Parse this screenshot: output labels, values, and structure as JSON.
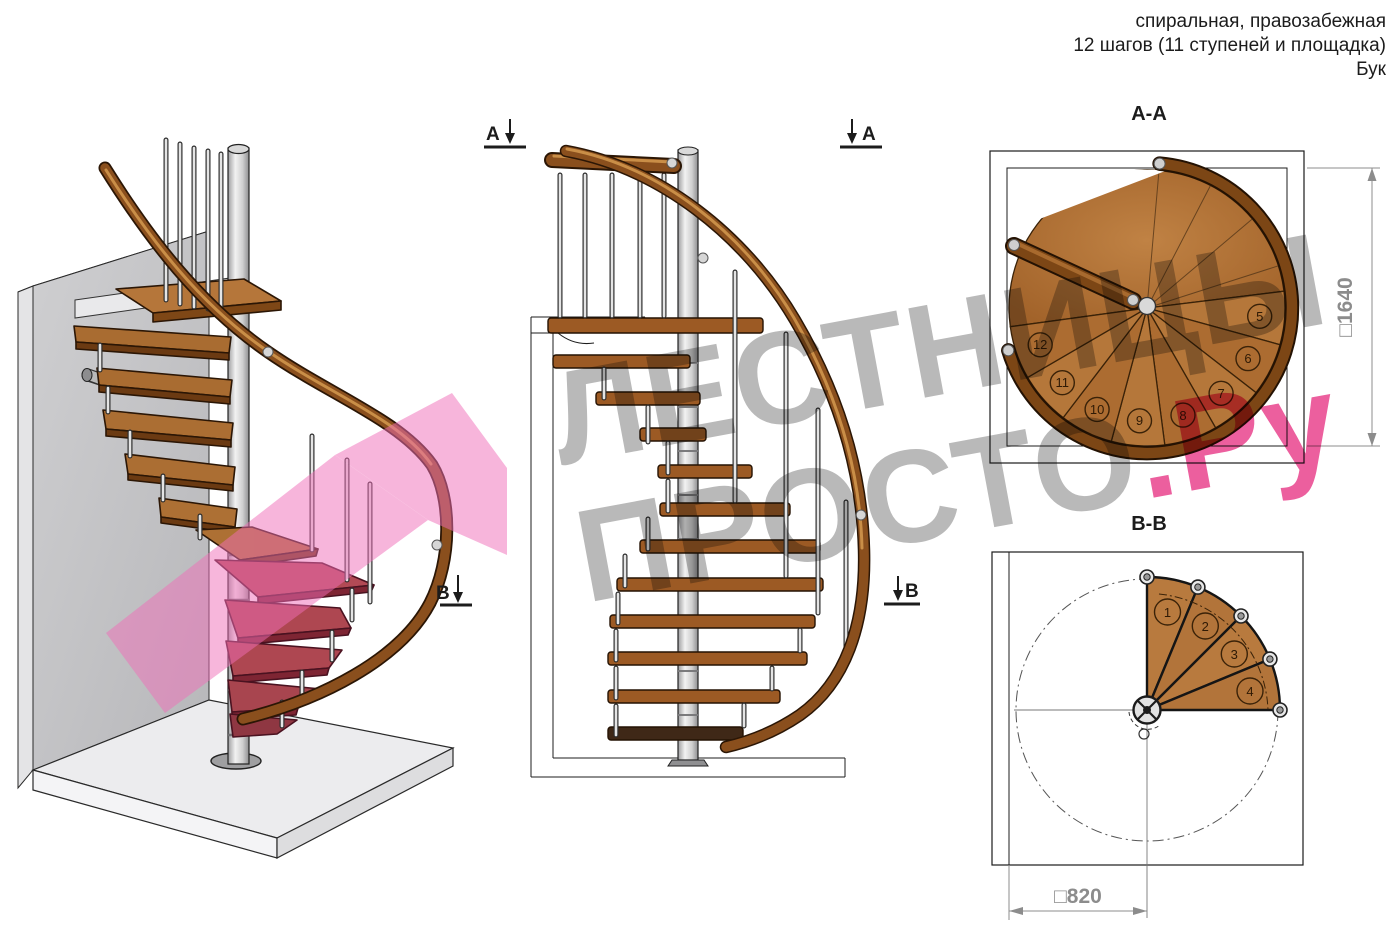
{
  "header": {
    "line1": "спиральная, правозабежная",
    "line2": "12 шагов (11 ступеней и площадка)",
    "line3": "Бук"
  },
  "watermark": {
    "line1": "ЛЕСТНИЦЫ",
    "line2": "ПРОСТО",
    "suffix": ".Ру"
  },
  "markers": {
    "a": "А",
    "b": "В"
  },
  "plan_aa": {
    "title": "А-А",
    "dimension": "□1640",
    "steps": [
      "5",
      "6",
      "7",
      "8",
      "9",
      "10",
      "11",
      "12"
    ]
  },
  "plan_bb": {
    "title": "В-В",
    "dimension": "□820",
    "steps": [
      "1",
      "2",
      "3",
      "4"
    ]
  },
  "colors": {
    "wood": "#b5773a",
    "wood_dark": "#6b3a12",
    "rail": "#8a4f1d",
    "metal": "#c9c9c9",
    "wall": "#c6c6c8",
    "floor": "#eaeaec",
    "section_pink": "#f06eb8",
    "cut_red": "#a8454f",
    "dim_gray": "#8c8c8c",
    "line": "#1c1c1c",
    "watermark_gray": "#b9b9b9",
    "watermark_pink": "#ec5f9e"
  }
}
